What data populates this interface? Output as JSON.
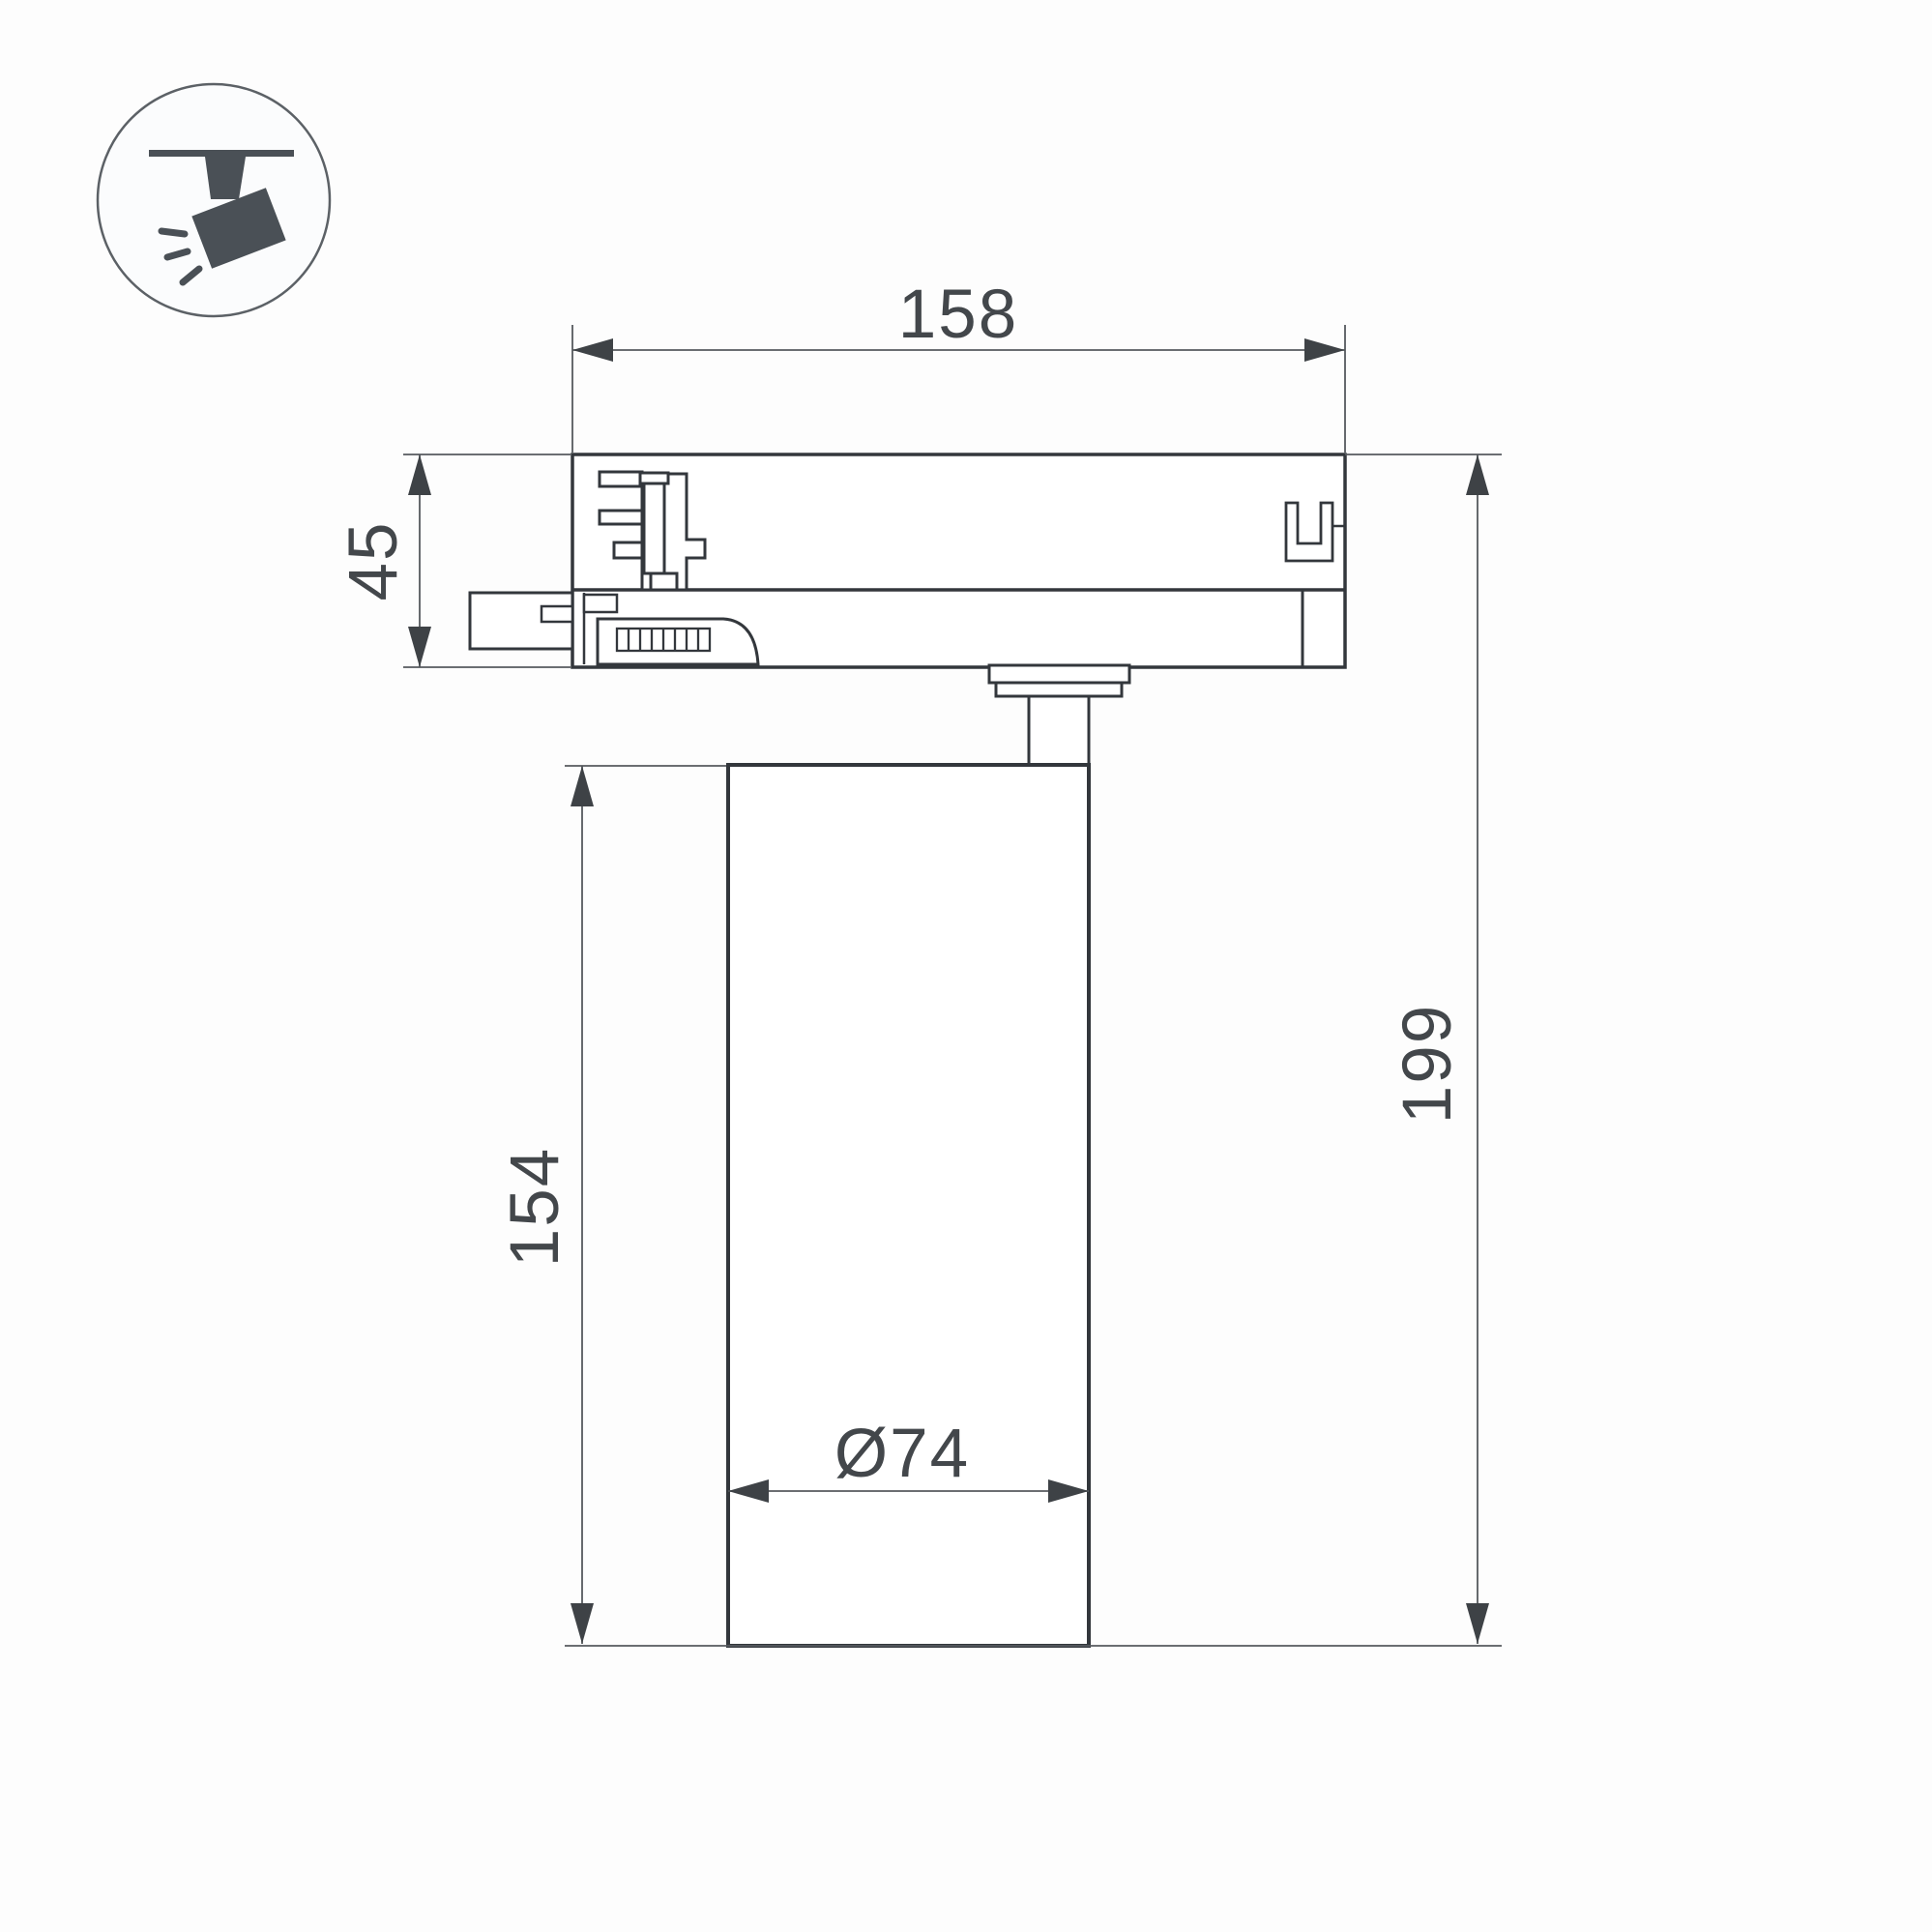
{
  "figure": {
    "kind": "technical dimension drawing of a track-mounted spotlight",
    "icon": {
      "name": "track-spotlight",
      "color": "#4a5056",
      "circle_stroke": "#5c6166",
      "circle_fill": "#fbfcfd"
    },
    "colors": {
      "outline": "#33373c",
      "dimension_lines": "#565a5e",
      "arrow_fill": "#3e4246",
      "text": "#43474b",
      "background": "#fdfdfd",
      "shape_fill": "#ffffff"
    },
    "dimensions": {
      "adapter_width": "158",
      "adapter_height": "45",
      "body_height": "154",
      "total_height": "199",
      "body_diameter": "Ø74"
    }
  }
}
